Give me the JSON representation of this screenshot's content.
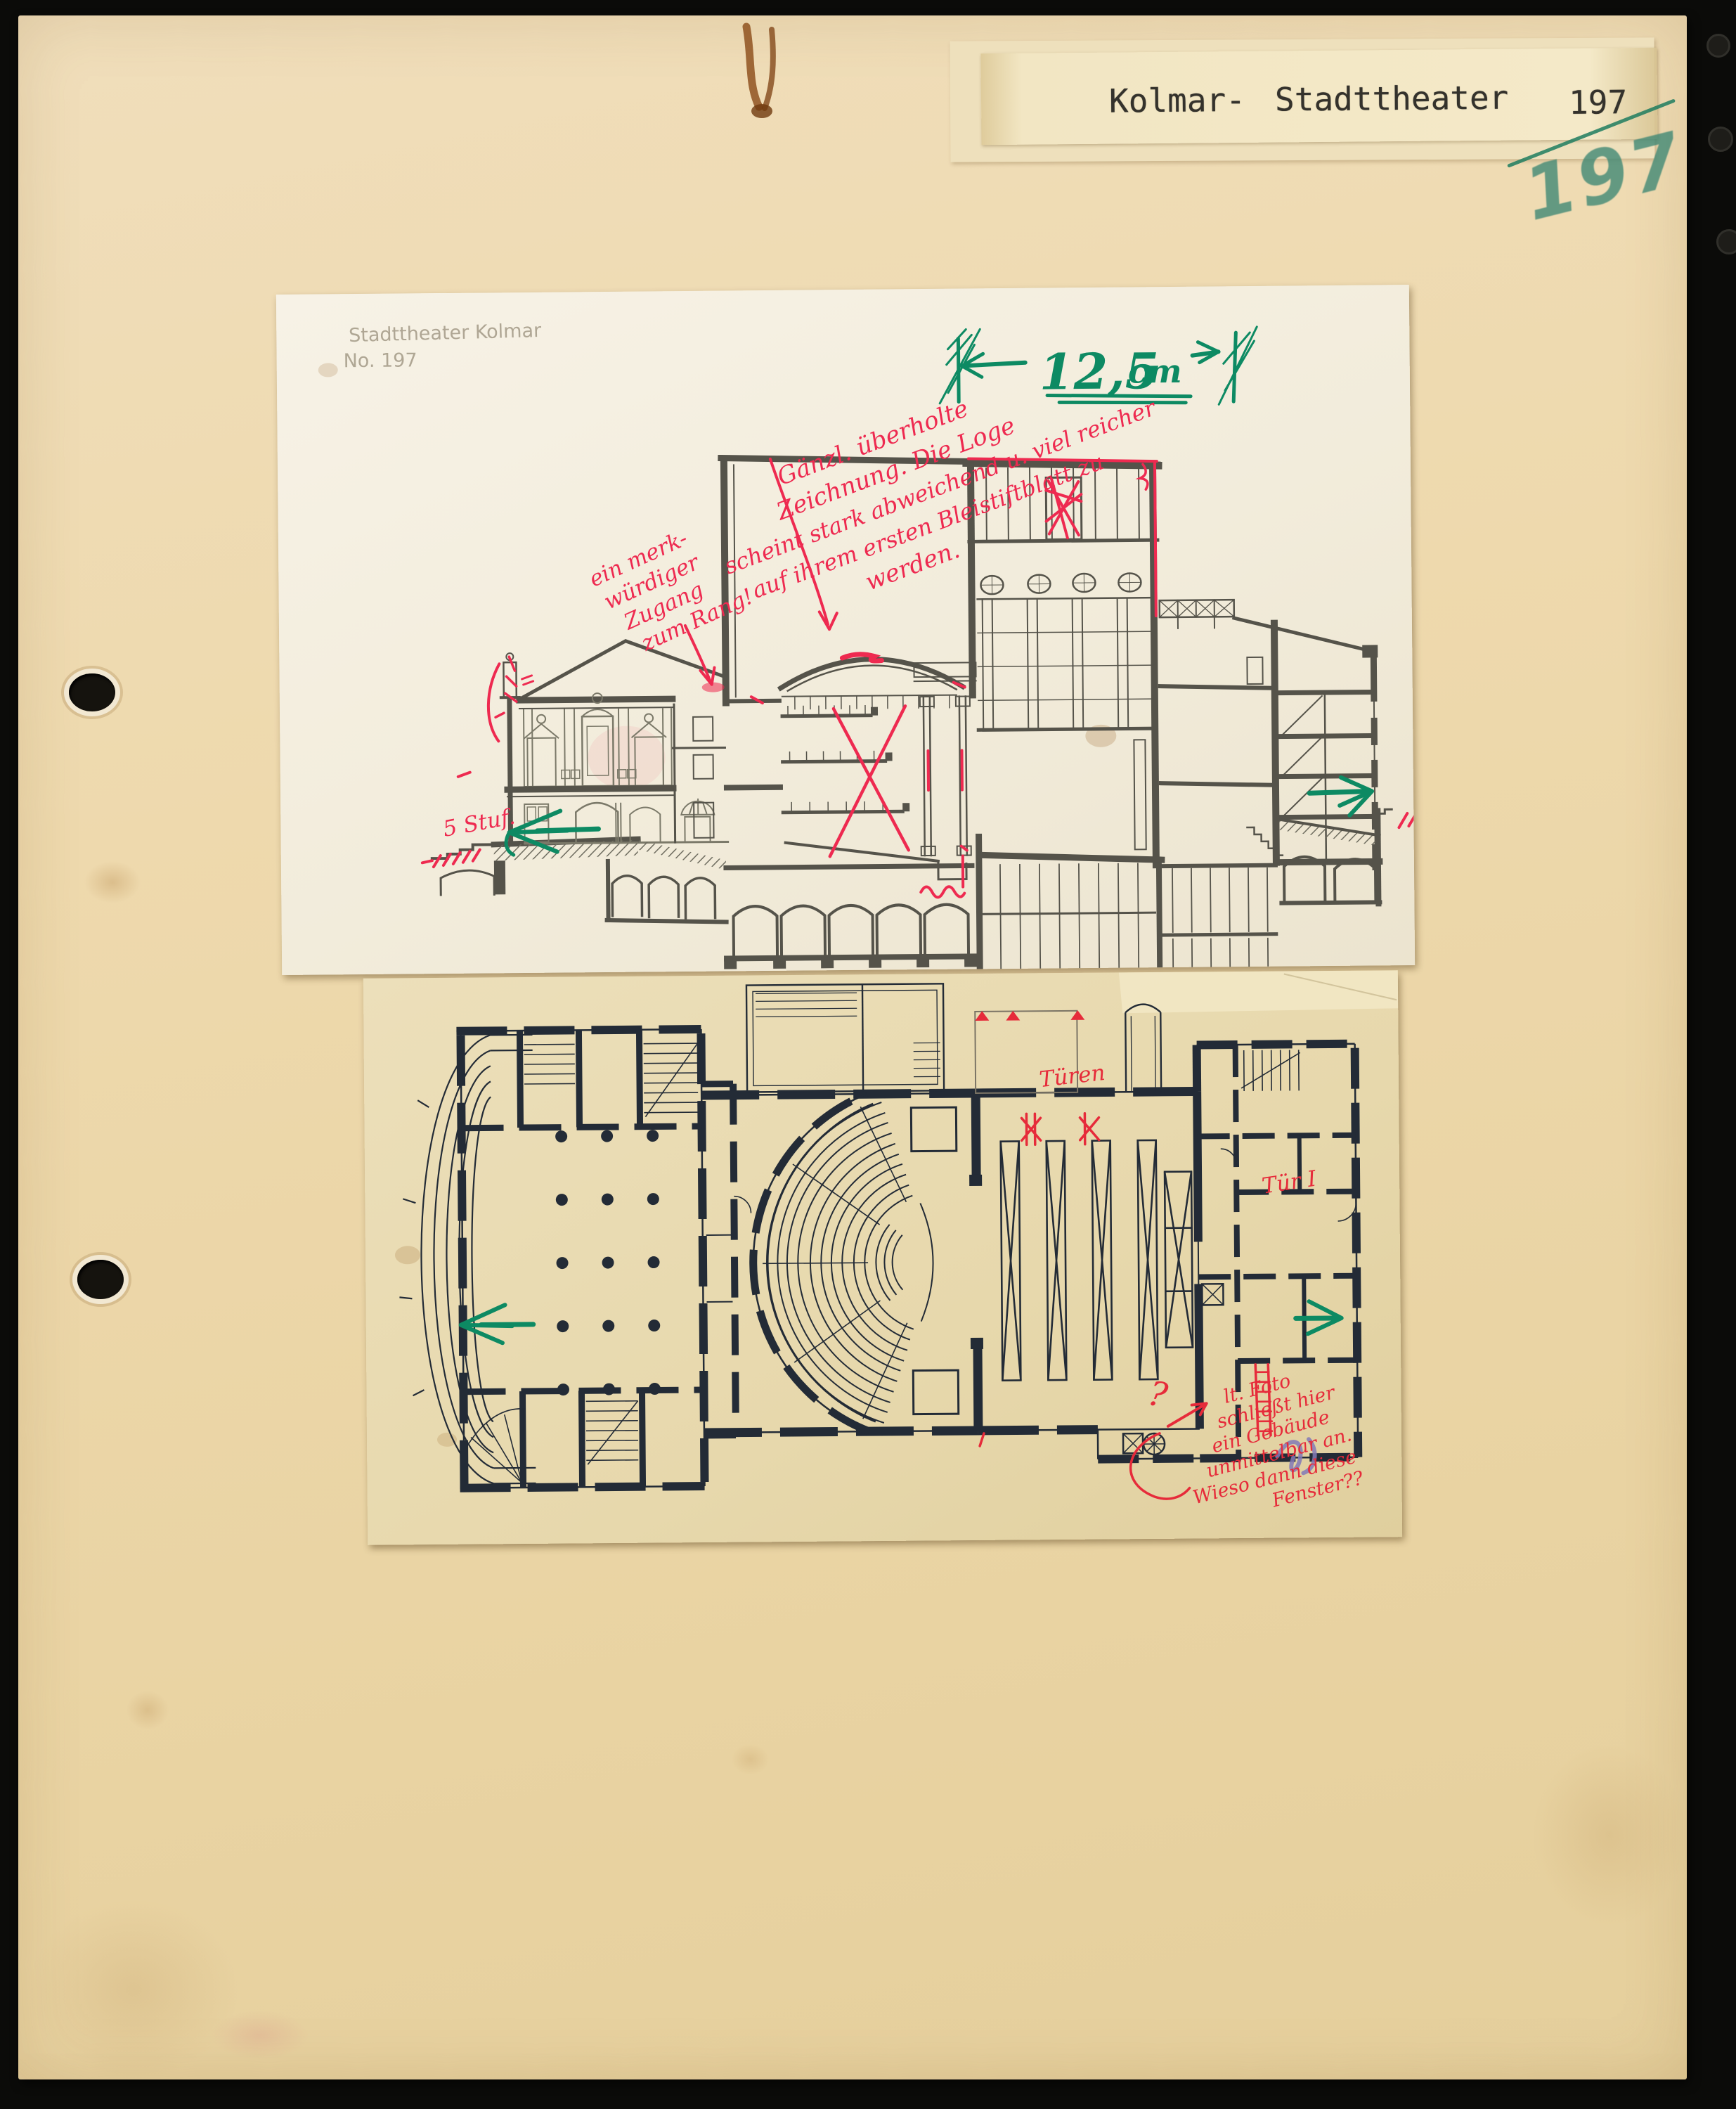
{
  "label": {
    "line_city": "Kolmar-",
    "line_title": "Stadttheater",
    "number": "197",
    "number_handwritten": "197"
  },
  "section_sheet": {
    "pencil_note_line1": "Stadttheater Kolmar",
    "pencil_note_line2": "No. 197",
    "dimension": {
      "value": "12,5",
      "unit": "cm"
    },
    "note_main": {
      "l1": "Gänzl. überholte",
      "l2": "Zeichnung. Die Loge",
      "l3": "scheint stark abweichend u. viel reicher",
      "l4": "auf ihrem ersten Bleistiftblatt zu",
      "l5": "werden."
    },
    "note_rang": {
      "l1": "ein merk-",
      "l2": "würdiger",
      "l3": "Zugang",
      "l4": "zum Rang!"
    },
    "note_steps": "5 Stuf."
  },
  "plan_sheet": {
    "note_doors": "Türen",
    "note_door_one": "Tür I",
    "note_photo": {
      "q": "?",
      "l1": "lt. Foto",
      "l2": "schließt hier",
      "l3": "ein Gebäude",
      "l4": "unmittelbar an.",
      "l5": "Wieso dann diese",
      "l6": "Fenster??"
    }
  },
  "colors": {
    "red_ink": "#ee2a50",
    "plan_red": "#e62b3a",
    "green_marker": "#0d8a63",
    "green_pencil": "#40887,4",
    "section_ink": "#55534a",
    "plan_ink": "#232b36",
    "rust": "#8a4a16"
  }
}
